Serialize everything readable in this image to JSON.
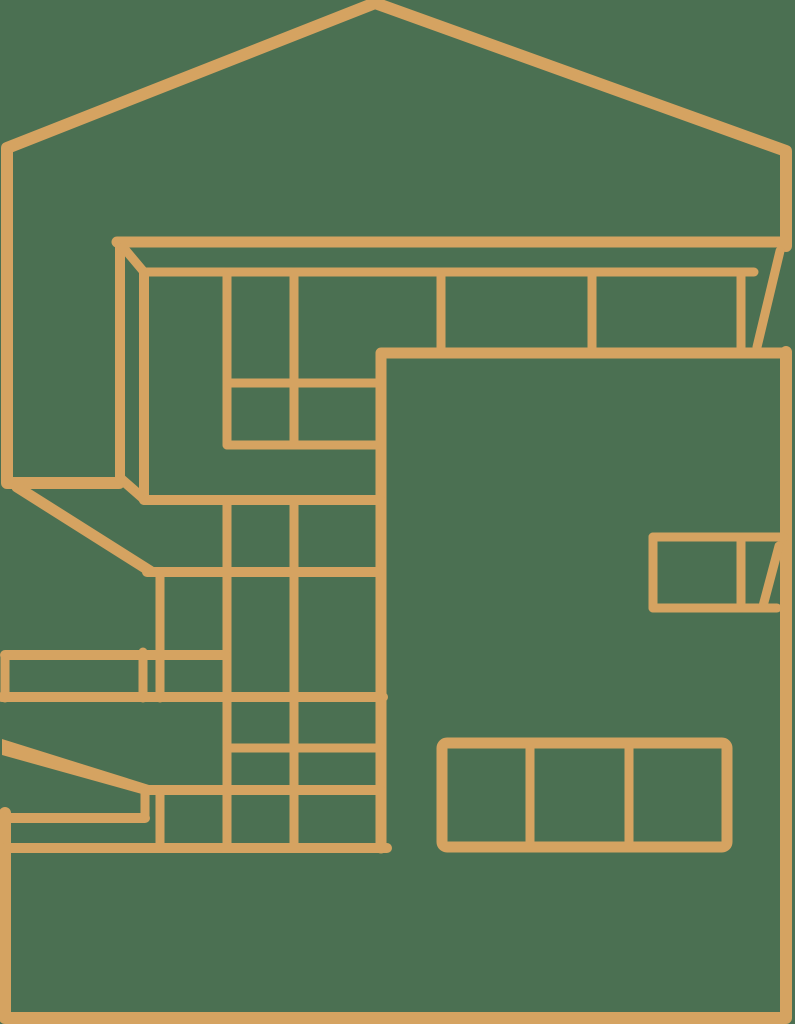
{
  "meta": {
    "title": "Modern house line illustration",
    "subject": "Single-color outline drawing of a two-story modern house with slanted roof and large window grids",
    "style": "monoline architectural illustration"
  },
  "theme": {
    "bg": "#4B7052",
    "line": "#D5A361"
  },
  "illustration": {
    "parts": [
      "roof-outline",
      "left-wall-edge",
      "roof-fascia-beam",
      "clerestory-window-strip",
      "upper-left-window-grid",
      "main-wall-panel",
      "mid-left-window-grid",
      "lower-terrace-slabs",
      "entry-ramp-wedge",
      "lower-right-three-pane-window",
      "right-side-corner-window",
      "base-and-right-edge"
    ]
  }
}
